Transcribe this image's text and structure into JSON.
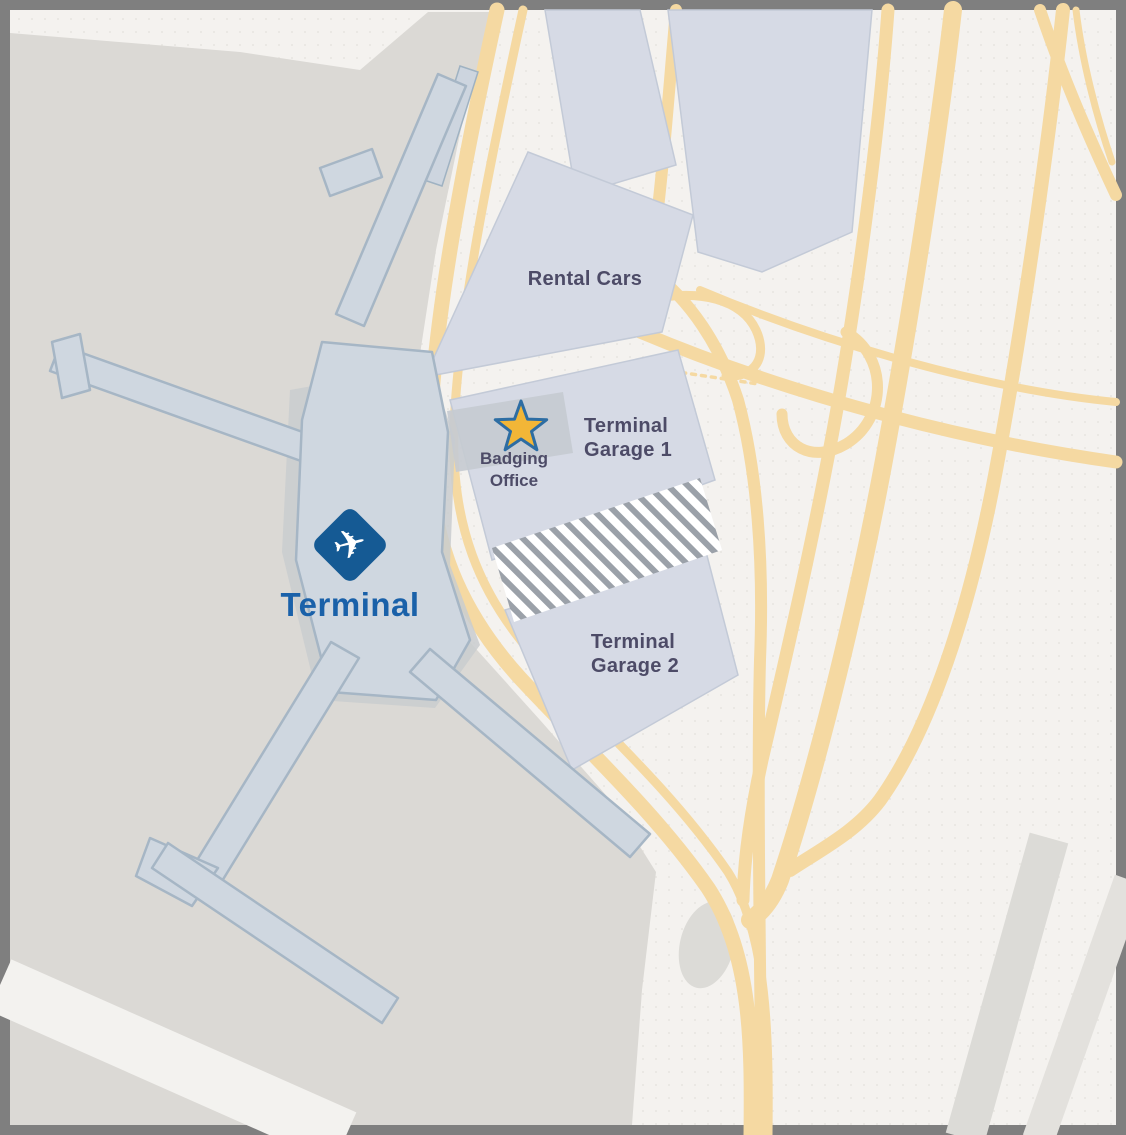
{
  "map": {
    "labels": {
      "terminal": "Terminal",
      "rental_cars": "Rental Cars",
      "garage1": {
        "line1": "Terminal",
        "line2": "Garage 1"
      },
      "garage2": {
        "line1": "Terminal",
        "line2": "Garage 2"
      },
      "badging_office": {
        "line1": "Badging",
        "line2": "Office"
      }
    },
    "icons": {
      "terminal_marker": "airplane-icon",
      "badging_office_marker": "star-icon"
    },
    "colors": {
      "frame_border": "#7f7f7f",
      "landside_background": "#f4f2ef",
      "airfield_gray": "#dbd9d5",
      "road_tan": "#f5d9a2",
      "building_fill": "#d6dae5",
      "building_edge": "#c3cad7",
      "terminal_fill": "#cfd7e0",
      "terminal_edge": "#a6b6c5",
      "apron_gray": "#c9cccf",
      "hatch_stripe": "#9ba1a9",
      "label_dark": "#4d4b67",
      "terminal_label_blue": "#1a61a9",
      "marker_diamond_blue": "#155a94",
      "star_gold": "#f2b637",
      "star_outline_blue": "#2d6da3",
      "badging_panel_gray": "#c6cbd1",
      "runway_band_gray": "#dcdbd7"
    }
  }
}
